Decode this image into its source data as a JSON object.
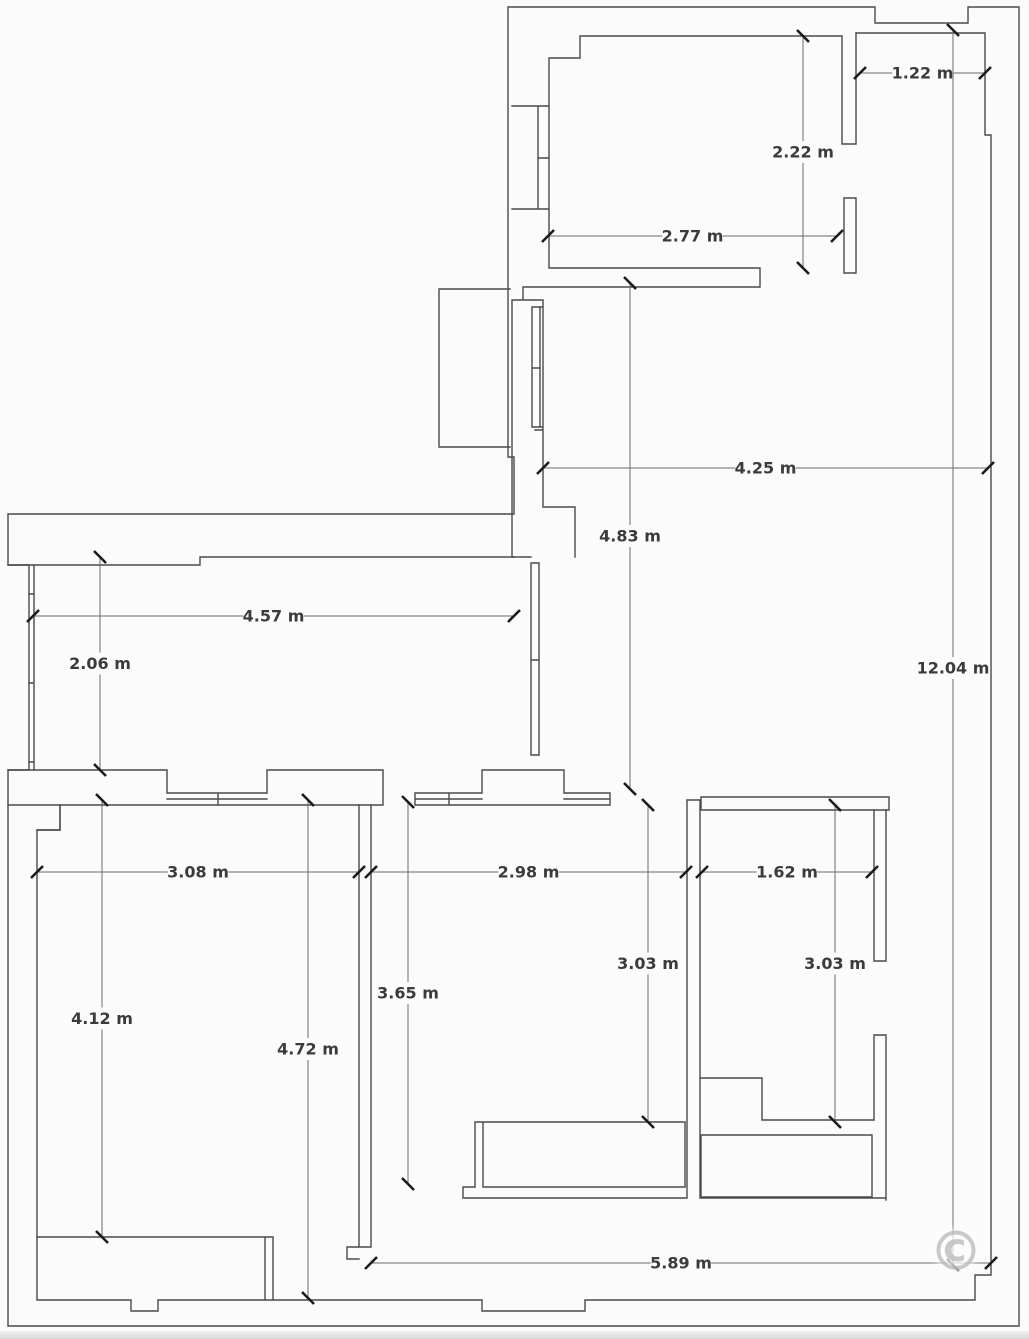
{
  "floor_plan": {
    "type": "apartment-floor-plan",
    "units": "m",
    "colors": {
      "background": "#fbfbfb",
      "wall": "#4a4a4a",
      "dimension_line": "#6b6b6b",
      "tick": "#1b1b1b",
      "label_text": "#3b3b3b",
      "watermark": "#a5a5a5"
    },
    "dimensions": [
      {
        "label": "1.22 m",
        "orient": "h",
        "x1": 860,
        "x2": 985,
        "y": 73
      },
      {
        "label": "2.22 m",
        "orient": "v",
        "x": 803,
        "y1": 36,
        "y2": 268
      },
      {
        "label": "2.77 m",
        "orient": "h",
        "x1": 548,
        "x2": 837,
        "y": 236
      },
      {
        "label": "4.25 m",
        "orient": "h",
        "x1": 543,
        "x2": 988,
        "y": 468
      },
      {
        "label": "4.83 m",
        "orient": "v",
        "x": 630,
        "y1": 283,
        "y2": 789
      },
      {
        "label": "4.57 m",
        "orient": "h",
        "x1": 33,
        "x2": 514,
        "y": 616
      },
      {
        "label": "2.06 m",
        "orient": "v",
        "x": 100,
        "y1": 557,
        "y2": 770
      },
      {
        "label": "12.04 m",
        "orient": "v",
        "x": 953,
        "y1": 30,
        "y2": 1265,
        "label_y": 668
      },
      {
        "label": "3.08 m",
        "orient": "h",
        "x1": 37,
        "x2": 359,
        "y": 872
      },
      {
        "label": "2.98 m",
        "orient": "h",
        "x1": 371,
        "x2": 686,
        "y": 872
      },
      {
        "label": "1.62 m",
        "orient": "h",
        "x1": 702,
        "x2": 872,
        "y": 872
      },
      {
        "label": "3.03 m",
        "orient": "v",
        "x": 648,
        "y1": 805,
        "y2": 1122
      },
      {
        "label": "3.03 m",
        "orient": "v",
        "x": 835,
        "y1": 805,
        "y2": 1122
      },
      {
        "label": "3.65 m",
        "orient": "v",
        "x": 408,
        "y1": 802,
        "y2": 1184
      },
      {
        "label": "4.12 m",
        "orient": "v",
        "x": 102,
        "y1": 800,
        "y2": 1237
      },
      {
        "label": "4.72 m",
        "orient": "v",
        "x": 308,
        "y1": 800,
        "y2": 1298
      },
      {
        "label": "5.89 m",
        "orient": "h",
        "x1": 371,
        "x2": 991,
        "y": 1263
      }
    ]
  },
  "watermark": {
    "glyph": "©"
  }
}
